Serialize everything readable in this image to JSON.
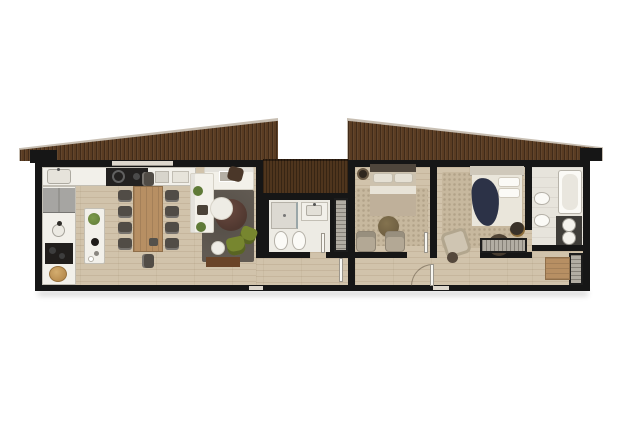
{
  "meta": {
    "description": "Top-down architectural floor-plan rendering of a single-storey house: two mono-pitch roofed volumes joined by a central wood deck; no text labels are rendered in the image",
    "visible_text": []
  },
  "palette": {
    "wall": "#161616",
    "floor": "#d1c3ab",
    "roofWood": "#5a3c22",
    "roofEdge": "#c7beb2",
    "deckWood": "#4f351d",
    "bathFloor": "#edebe4",
    "tileFloor": "#e7e4dc",
    "rugDark": "#615a52",
    "rugBeige": "#c7b89e",
    "sofaWhite": "#f3f1ea",
    "oliveChair": "#77862f",
    "woodTable": "#b78f63",
    "darkConsole": "#6a4428",
    "maroonTable": "#503830",
    "steel": "#a6a5a2",
    "applianceDark": "#232120",
    "navyBlanket": "#2c3247",
    "bedTan": "#cdc2ae",
    "headboardDark": "#4f463c",
    "plantGreen": "#5f7a37",
    "wardrobeBg": "#b2ada3",
    "wardrobeLine": "#858077",
    "basket": "#b98e51",
    "brass": "#b8923f",
    "fixtureWhite": "#f2f0ea",
    "doorGap": "#ddd7cd"
  },
  "rooms": {
    "open_plan": {
      "label": "Open-plan kitchen, dining and living room",
      "furniture": [
        "wall counter with sink and cooktop",
        "refrigerator",
        "second sink and hob",
        "bread basket",
        "kitchen island with plant",
        "ten-seat wooden dining table",
        "white corner sofa",
        "dark grey rug",
        "round maroon coffee table",
        "round white side table",
        "two olive armchairs",
        "white pouf",
        "dark media sideboard"
      ]
    },
    "guest_bathroom": {
      "label": "Guest bathroom",
      "furniture": [
        "shower",
        "washbasin vanity",
        "toilet",
        "bidet",
        "door"
      ]
    },
    "middle_bedroom": {
      "label": "Bedroom with wood stove",
      "furniture": [
        "double bed",
        "area rug",
        "round pouf",
        "two armchairs",
        "wood stove"
      ]
    },
    "master_bedroom": {
      "label": "Master bedroom",
      "furniture": [
        "double bed with navy throw",
        "area rug",
        "lounge chair",
        "round side table",
        "dark pouf with kettle",
        "brass table",
        "built-in wardrobe"
      ]
    },
    "master_bathroom": {
      "label": "Master bathroom",
      "furniture": [
        "bathtub",
        "twin round basins on dark counter",
        "toilet",
        "bidet"
      ]
    },
    "walk_in_closet": {
      "label": "Walk-in closet",
      "furniture": [
        "wardrobe",
        "wooden dresser"
      ]
    },
    "hallway": {
      "label": "Hallway with entrance door",
      "furniture": [
        "entrance door with swing arc",
        "interior doors"
      ]
    },
    "deck": {
      "label": "Central wood deck between the two volumes",
      "furniture": []
    },
    "roof_left": {
      "label": "Left mono-pitch timber roof"
    },
    "roof_right": {
      "label": "Right mono-pitch timber roof"
    },
    "central_wardrobe": {
      "label": "Built-in wardrobe beside guest bathroom"
    }
  }
}
